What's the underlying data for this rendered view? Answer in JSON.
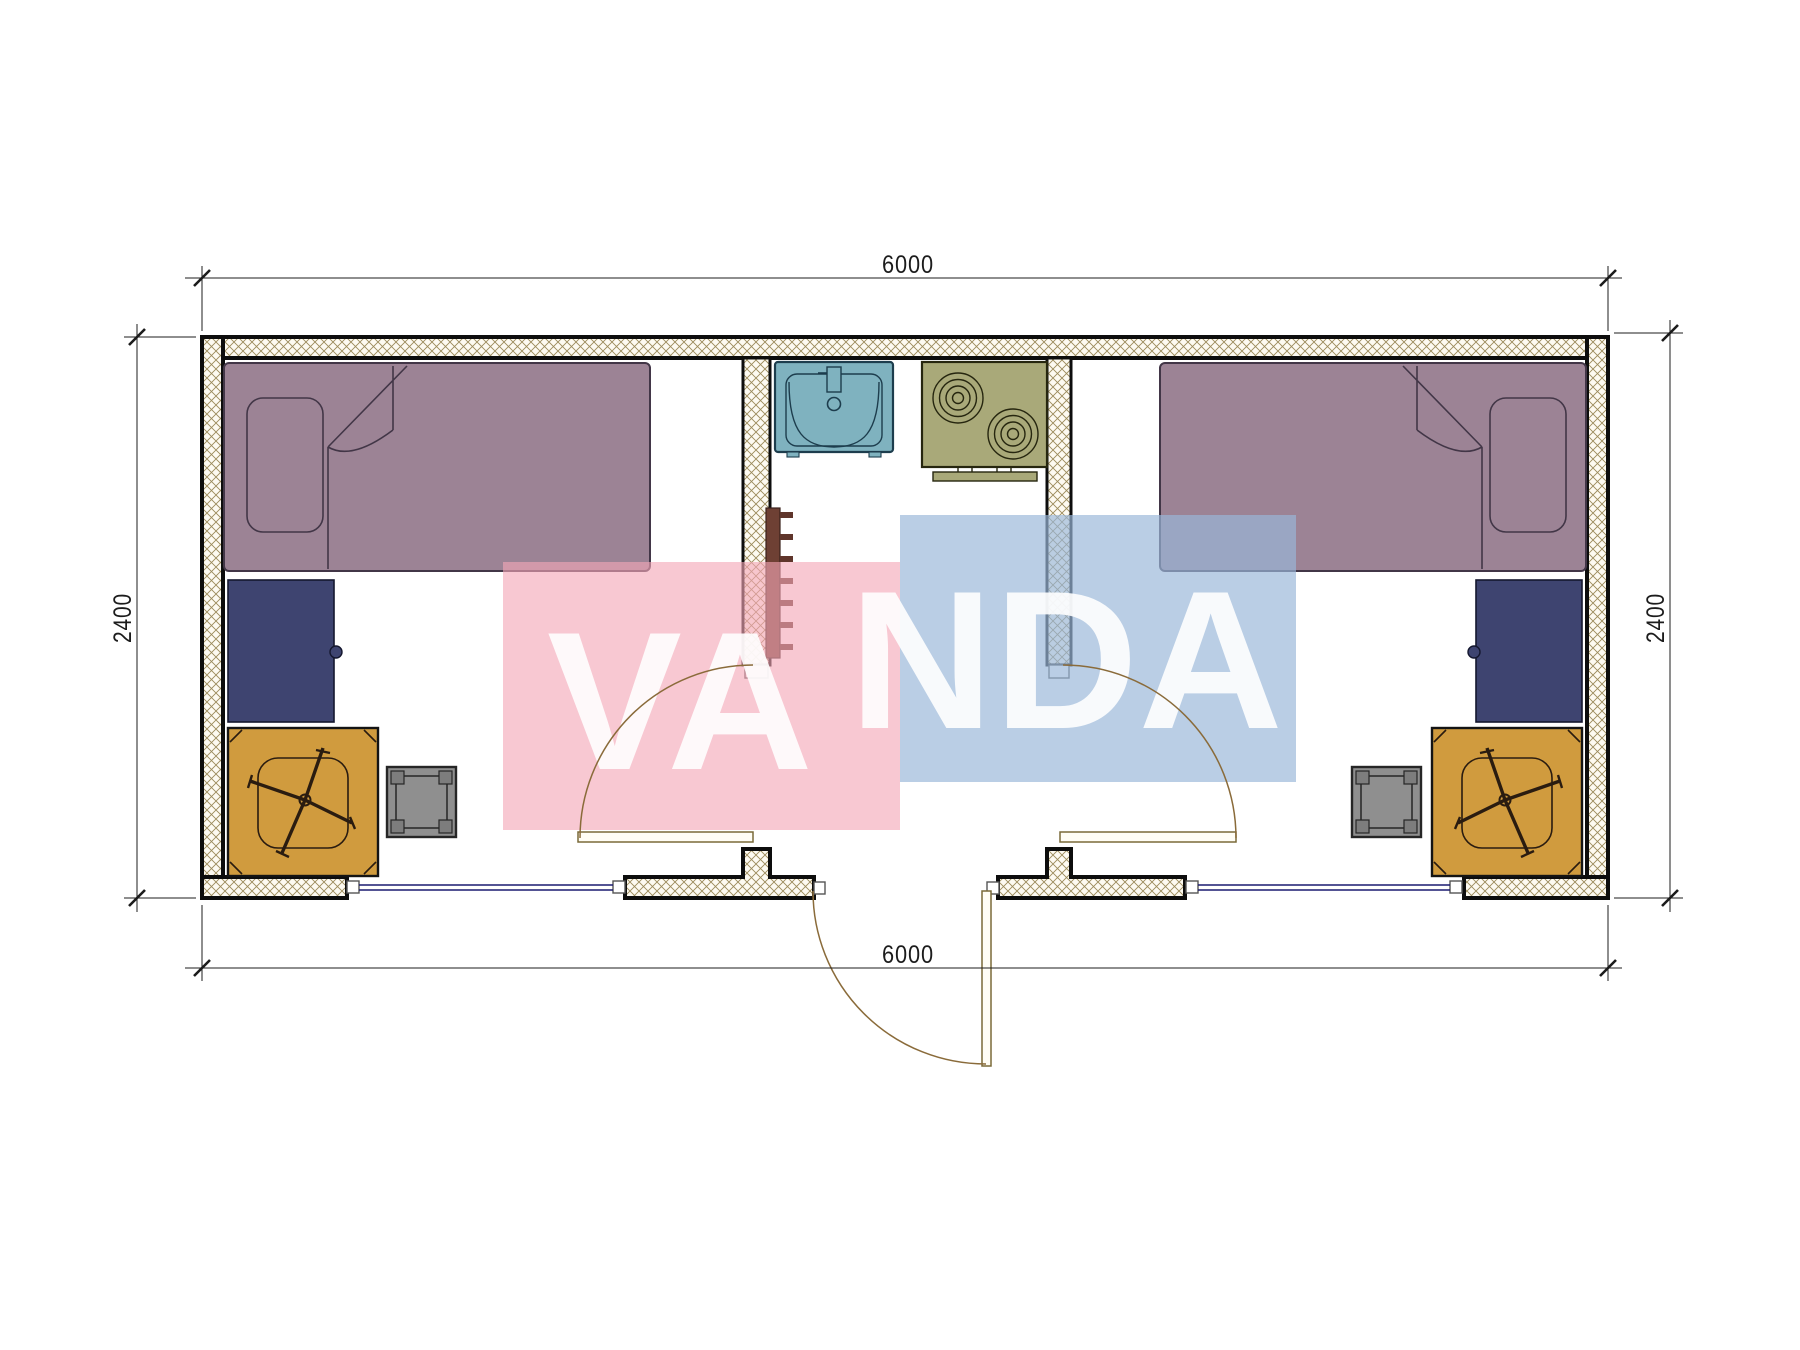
{
  "title": "container-house-floor-plan",
  "watermark": {
    "word": "VANDA",
    "part1": "VA",
    "part2": "NDA",
    "pink_block": "#f3a6b7",
    "blue_block": "#99b7d9",
    "letter_color": "#ffffff"
  },
  "dimensions": {
    "top": "6000",
    "bottom": "6000",
    "left": "2400",
    "right": "2400"
  },
  "colors": {
    "bed": "#9c8395",
    "bed_line": "#423647",
    "cabinet": "#3e4470",
    "cabinet_line": "#14172e",
    "desk": "#d09b3e",
    "stool": "#8f8f8f",
    "stool_dark": "#7d7d7d",
    "sink": "#7fb2bf",
    "sink_line": "#1d3d4d",
    "stove": "#a9a979",
    "stove_line": "#26260f",
    "ladder": "#6e4034",
    "ladder_rung": "#5f352b",
    "hatch_line": "#9b8a5a",
    "wall_fill": "#fdfaf1",
    "wall_line": "#0d0d0d",
    "glazing": "#1b1b70",
    "door": "#8a6b3a",
    "door_leaf_fill": "#fffdf5",
    "dim_line": "#1c1c1c"
  },
  "items": {
    "rooms": [
      "bedroom-left",
      "kitchen-bath-corridor",
      "bedroom-right"
    ],
    "furniture": [
      "single-bed",
      "pillow",
      "wardrobe-cabinet",
      "office-desk",
      "swivel-chair",
      "stool",
      "wash-basin",
      "two-burner-stove",
      "towel-ladder-radiator",
      "swing-door"
    ]
  }
}
